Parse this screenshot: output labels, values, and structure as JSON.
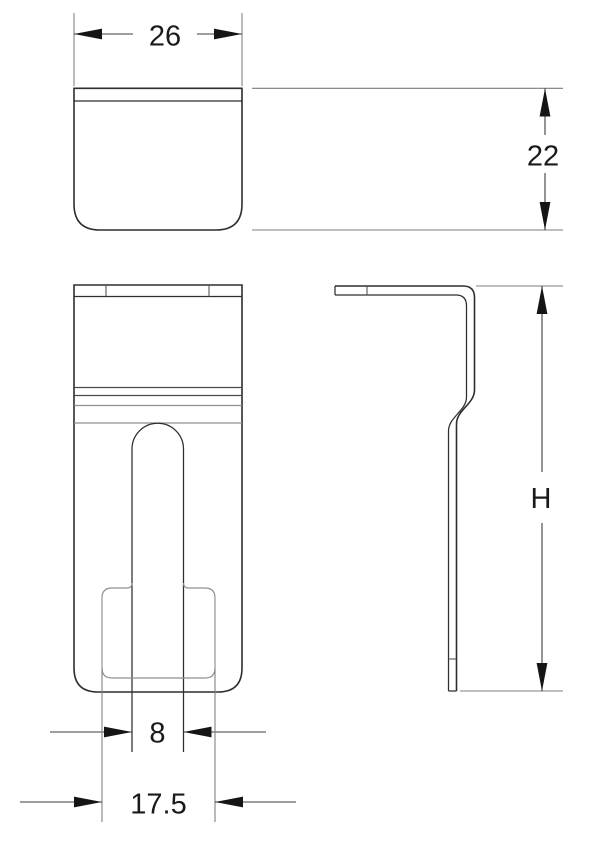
{
  "drawing": {
    "type": "technical-drawing",
    "part": "sheet-metal clip, three orthographic views",
    "colors": {
      "background": "#ffffff",
      "line": "#2e2e2e",
      "text": "#1a1a1a"
    },
    "dimensions": {
      "top_view_width": {
        "label": "26"
      },
      "top_view_depth": {
        "label": "22"
      },
      "slot_width": {
        "label": "8"
      },
      "pocket_width": {
        "label": "17.5"
      },
      "overall_height": {
        "label": "H"
      }
    }
  }
}
